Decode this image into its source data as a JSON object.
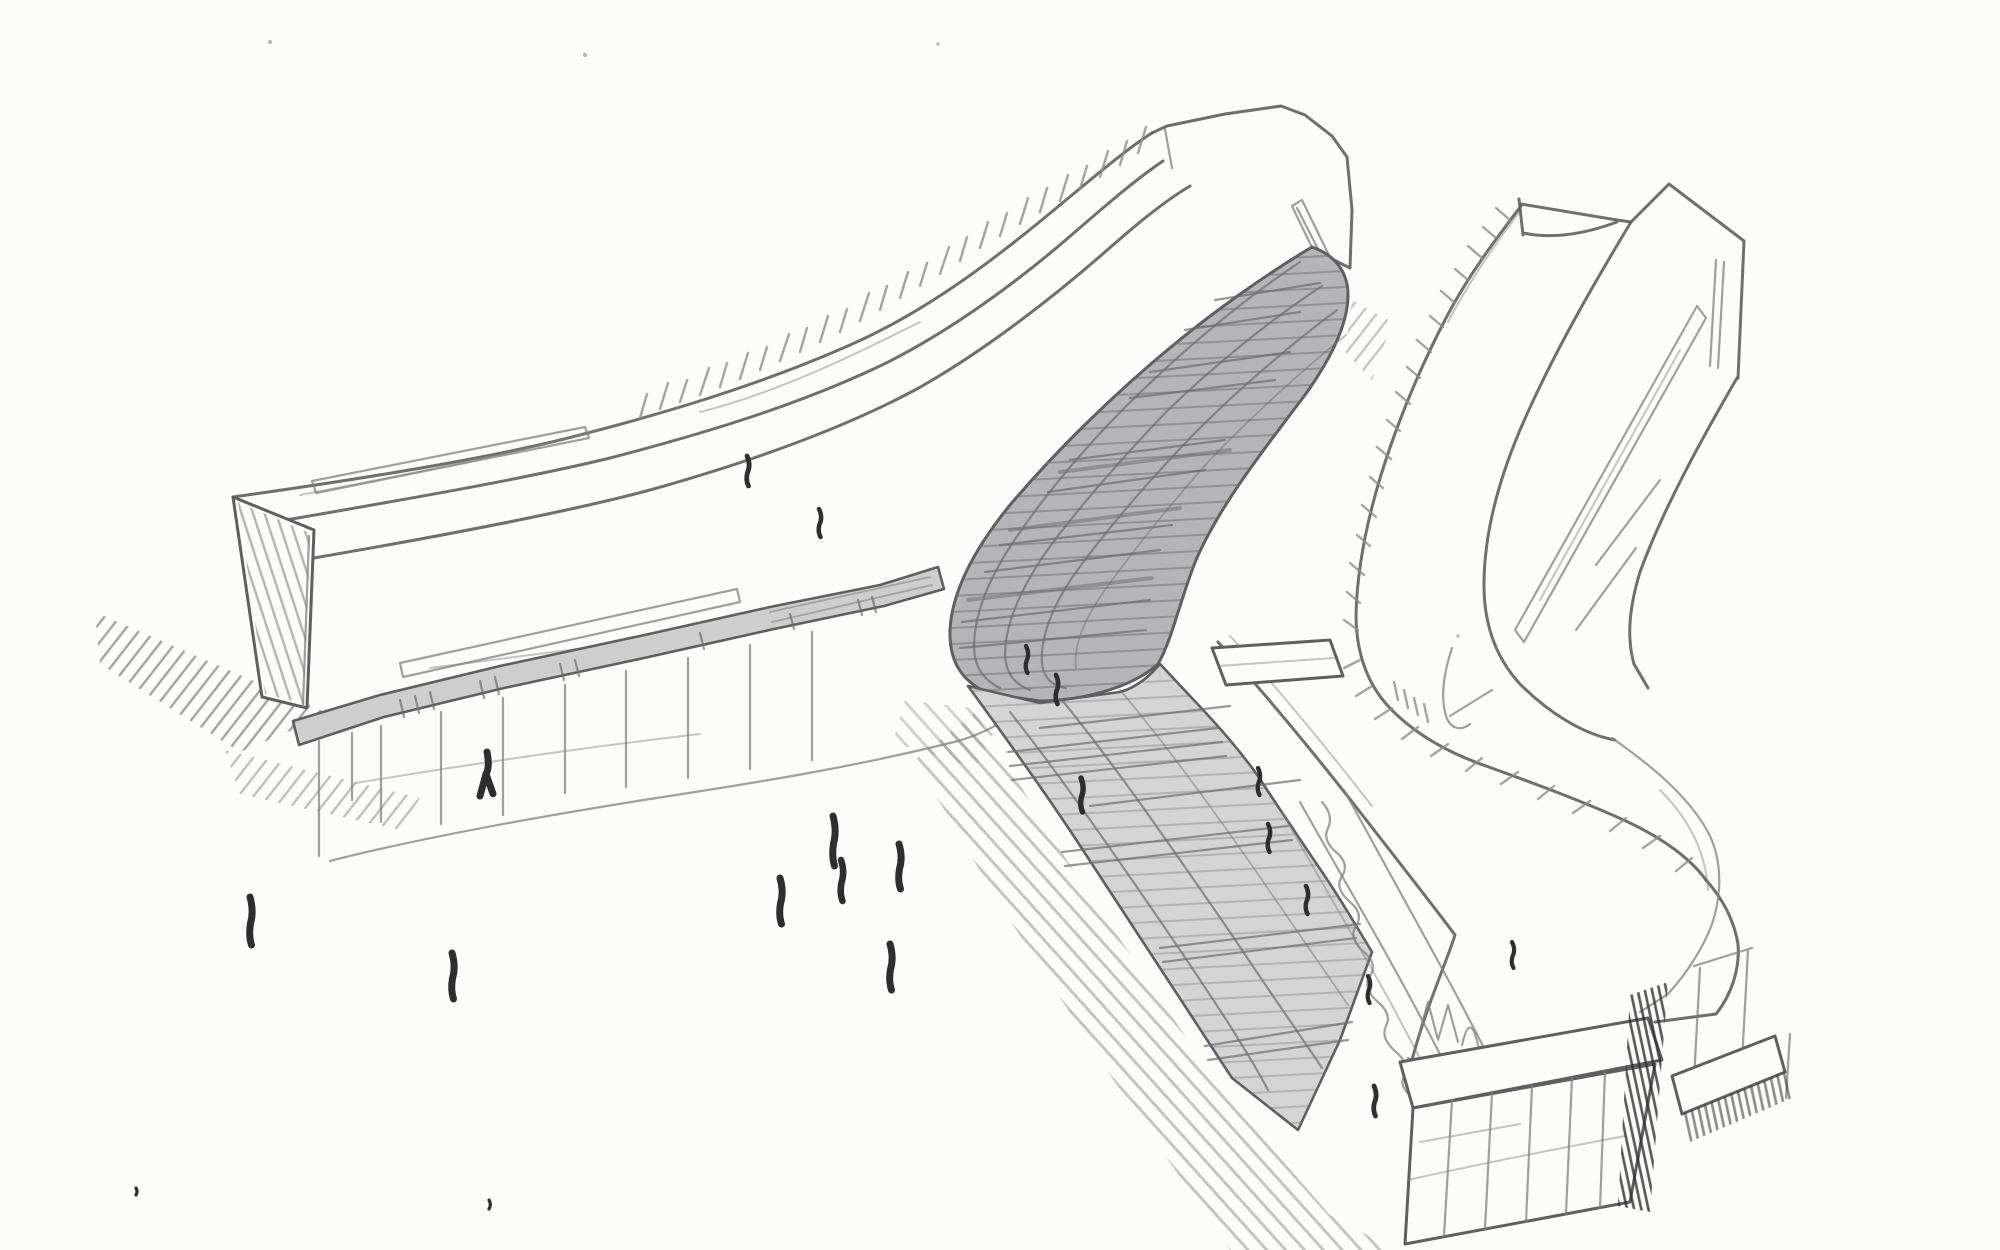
{
  "palette": {
    "paper": "#fcfcfa",
    "pencil": "#5f5f61",
    "pencil_light": "#808082",
    "pencil_dark": "#2e2e30",
    "hatch": "#8d8d8f",
    "glaze_dark": "#b5b5b7",
    "glaze_light": "#d4d4d5",
    "canopy": "#cecece",
    "glaze_line": "#6c6c6e"
  },
  "scene": {
    "people": [
      {
        "x": 250,
        "y": 897,
        "h": 48
      },
      {
        "x": 452,
        "y": 953,
        "h": 46
      },
      {
        "x": 487,
        "y": 752,
        "h": 44,
        "v": "x"
      },
      {
        "x": 747,
        "y": 456,
        "h": 30
      },
      {
        "x": 819,
        "y": 509,
        "h": 28
      },
      {
        "x": 780,
        "y": 878,
        "h": 46
      },
      {
        "x": 833,
        "y": 816,
        "h": 50
      },
      {
        "x": 899,
        "y": 844,
        "h": 45
      },
      {
        "x": 841,
        "y": 860,
        "h": 41
      },
      {
        "x": 890,
        "y": 944,
        "h": 46
      },
      {
        "x": 1026,
        "y": 646,
        "h": 27
      },
      {
        "x": 1056,
        "y": 675,
        "h": 29
      },
      {
        "x": 1081,
        "y": 778,
        "h": 34
      },
      {
        "x": 1258,
        "y": 768,
        "h": 27
      },
      {
        "x": 1268,
        "y": 824,
        "h": 28
      },
      {
        "x": 1306,
        "y": 886,
        "h": 28
      },
      {
        "x": 1368,
        "y": 976,
        "h": 27
      },
      {
        "x": 1374,
        "y": 1086,
        "h": 30
      },
      {
        "x": 1512,
        "y": 942,
        "h": 26
      },
      {
        "x": 489,
        "y": 1200,
        "h": 9,
        "v": "dot"
      },
      {
        "x": 136,
        "y": 1188,
        "h": 7,
        "v": "dot"
      }
    ],
    "specks": [
      {
        "x": 270,
        "y": 42,
        "r": 2
      },
      {
        "x": 585,
        "y": 55,
        "r": 2.2
      },
      {
        "x": 938,
        "y": 44,
        "r": 1.8
      },
      {
        "x": 1458,
        "y": 636,
        "r": 1.6
      },
      {
        "x": 1048,
        "y": 463,
        "r": 1.5
      }
    ]
  }
}
